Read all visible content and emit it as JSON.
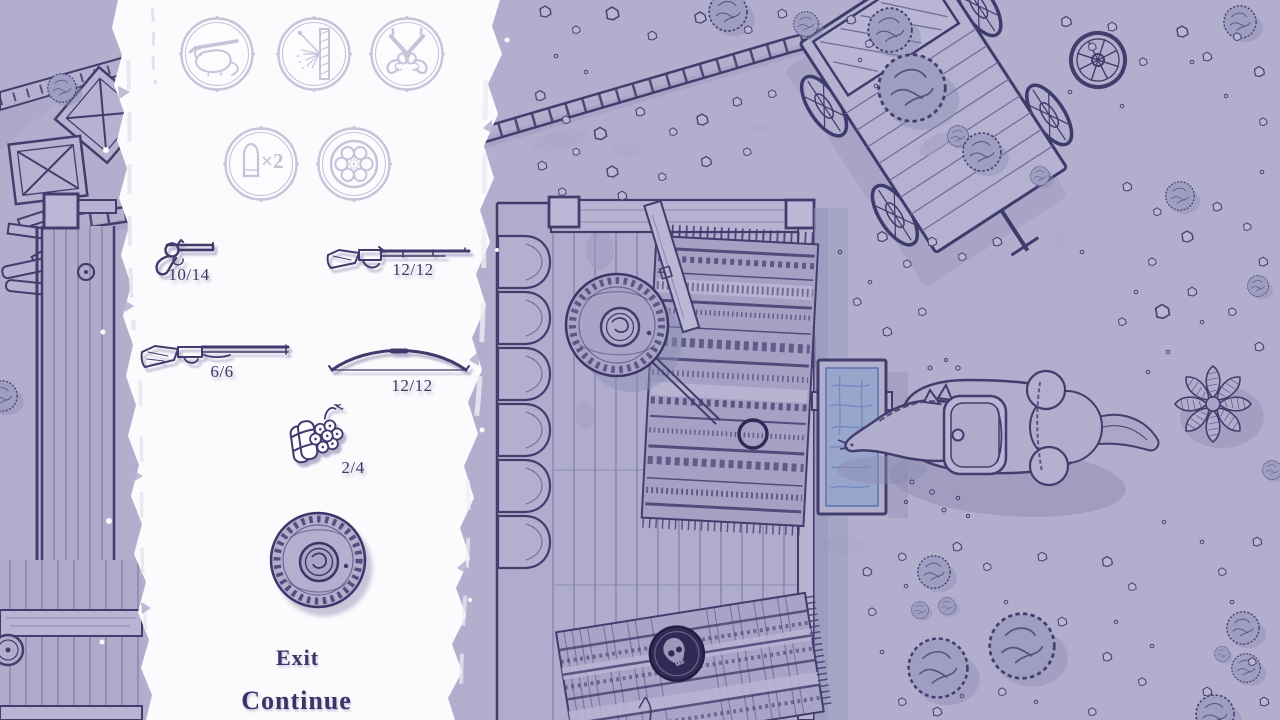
{
  "theme": {
    "ground": "#b2afce",
    "ink": "#433d6e",
    "panel_white": "#fbfafd",
    "dimmed_icon": "#c5c4da",
    "item_ink": "#413b6d",
    "label_text": "#3e3869",
    "water": "#98a6cb",
    "skull_badge_bg": "#2f2b56",
    "shadow": "#8f8cb4"
  },
  "loadout_panel": {
    "perks": [
      {
        "id": "pack-rat",
        "icon": "rat-with-rifle-icon",
        "dimmed": true
      },
      {
        "id": "penetration",
        "icon": "bullet-through-plank-icon",
        "dimmed": true
      },
      {
        "id": "dual-wield",
        "icon": "crossed-revolvers-icon",
        "dimmed": true
      },
      {
        "id": "double-ammo",
        "icon": "rifle-cartridge-icon",
        "label": "×2",
        "dimmed": true
      },
      {
        "id": "extra-cylinder",
        "icon": "revolver-cylinder-icon",
        "dimmed": true
      }
    ],
    "weapons": [
      {
        "id": "revolver",
        "icon": "revolver-icon",
        "ammo": "10/14"
      },
      {
        "id": "rifle",
        "icon": "lever-action-rifle-icon",
        "ammo": "12/12"
      },
      {
        "id": "shotgun",
        "icon": "double-barrel-shotgun-icon",
        "ammo": "6/6"
      },
      {
        "id": "bow",
        "icon": "bow-icon",
        "ammo": "12/12"
      },
      {
        "id": "dynamite",
        "icon": "dynamite-bundle-icon",
        "ammo": "2/4"
      }
    ],
    "hat": {
      "id": "sombrero",
      "icon": "sombrero-icon"
    },
    "buttons": {
      "exit": "Exit",
      "continue": "Continue"
    }
  },
  "scene": {
    "style": "hand-drawn top-down western map, monochrome purple ink",
    "elements": [
      "wooden-wagon",
      "boardwalk",
      "roof",
      "crates",
      "plank-door",
      "deck-porch",
      "log-pile",
      "patterned-rug",
      "leaning-board",
      "player-with-sombrero",
      "aim-reticle",
      "water-trough",
      "horse-drinking",
      "saddle-bags",
      "skull-marker-rug",
      "bushes",
      "rocks",
      "agave-plant",
      "spare-wheel",
      "barrel"
    ]
  }
}
